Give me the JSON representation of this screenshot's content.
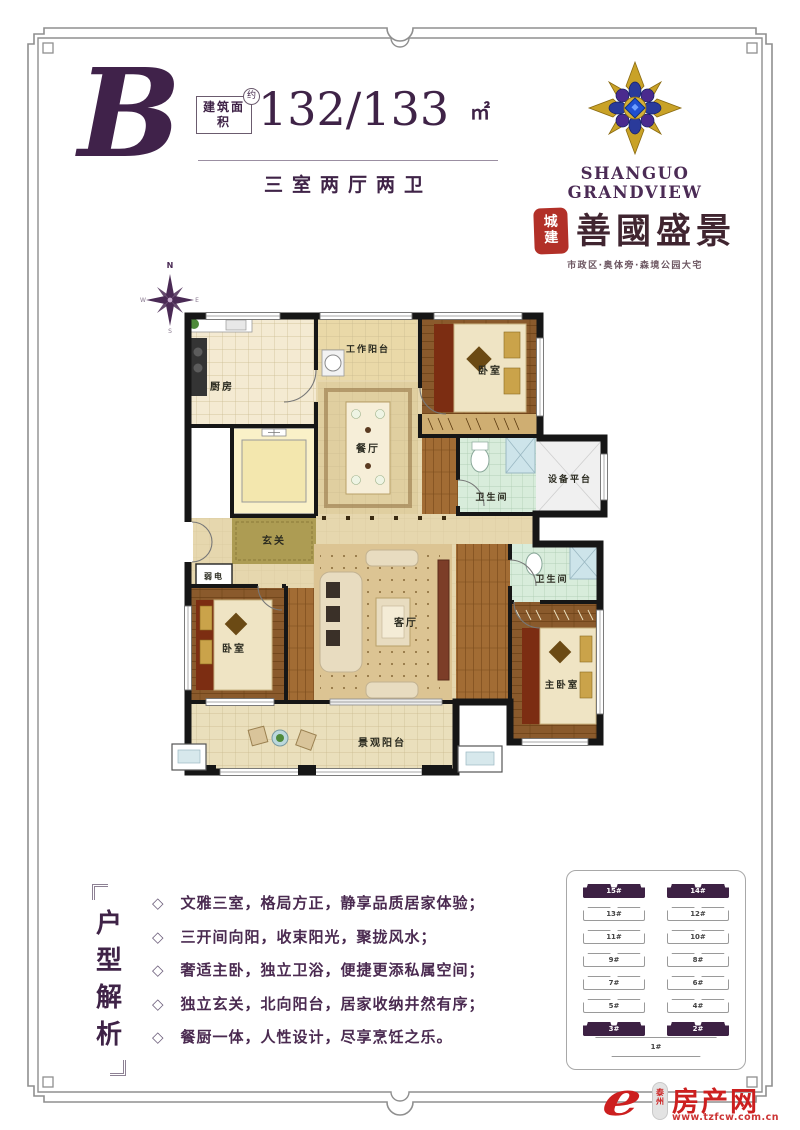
{
  "unit": {
    "letter": "B",
    "area_label": "建筑面积",
    "approx_badge": "约",
    "area_value": "132/133",
    "area_unit": "㎡",
    "layout_text": "三室两厅两卫"
  },
  "brand": {
    "name_en": "SHANGUO GRANDVIEW",
    "seal_char_top": "城",
    "seal_char_bottom": "建",
    "name_cn": "善國盛景",
    "tagline": "市政区·奥体旁·森境公园大宅"
  },
  "compass": {
    "n": "N",
    "e": "E",
    "s": "S",
    "w": "W"
  },
  "floorplan": {
    "rooms": {
      "kitchen": "厨房",
      "work_balcony": "工作阳台",
      "bedroom_north": "卧室",
      "dining": "餐厅",
      "bath_upper": "卫生间",
      "equipment": "设备平台",
      "foyer": "玄关",
      "weak_power": "弱电",
      "bedroom_west": "卧室",
      "living": "客厅",
      "bath_lower": "卫生间",
      "master_bedroom": "主卧室",
      "view_balcony": "景观阳台"
    }
  },
  "analysis": {
    "title": "户型解析",
    "bullet_marker": "◇",
    "bullets": [
      "文雅三室，格局方正，静享品质居家体验；",
      "三开间向阳，收束阳光，聚拢风水；",
      "奢适主卧，独立卫浴，便捷更添私属空间；",
      "独立玄关，北向阳台，居家收纳井然有序；",
      "餐厨一体，人性设计，尽享烹饪之乐。"
    ]
  },
  "siteplan": {
    "left_column": [
      "15#",
      "13#",
      "11#",
      "9#",
      "7#",
      "5#",
      "3#"
    ],
    "right_column": [
      "14#",
      "12#",
      "10#",
      "8#",
      "6#",
      "4#",
      "2#"
    ],
    "bottom_building": "1#",
    "highlighted": [
      "15#",
      "14#",
      "3#",
      "2#"
    ]
  },
  "footer": {
    "site_region": "泰州",
    "site_name": "房产网",
    "site_url": "www.tzfcw.com.cn"
  },
  "colors": {
    "accent_purple": "#3f2347",
    "seal_red": "#b23028",
    "logo_red": "#cc1f1f",
    "emblem_gold": "#c9a227",
    "emblem_blue": "#1e4fd0"
  }
}
